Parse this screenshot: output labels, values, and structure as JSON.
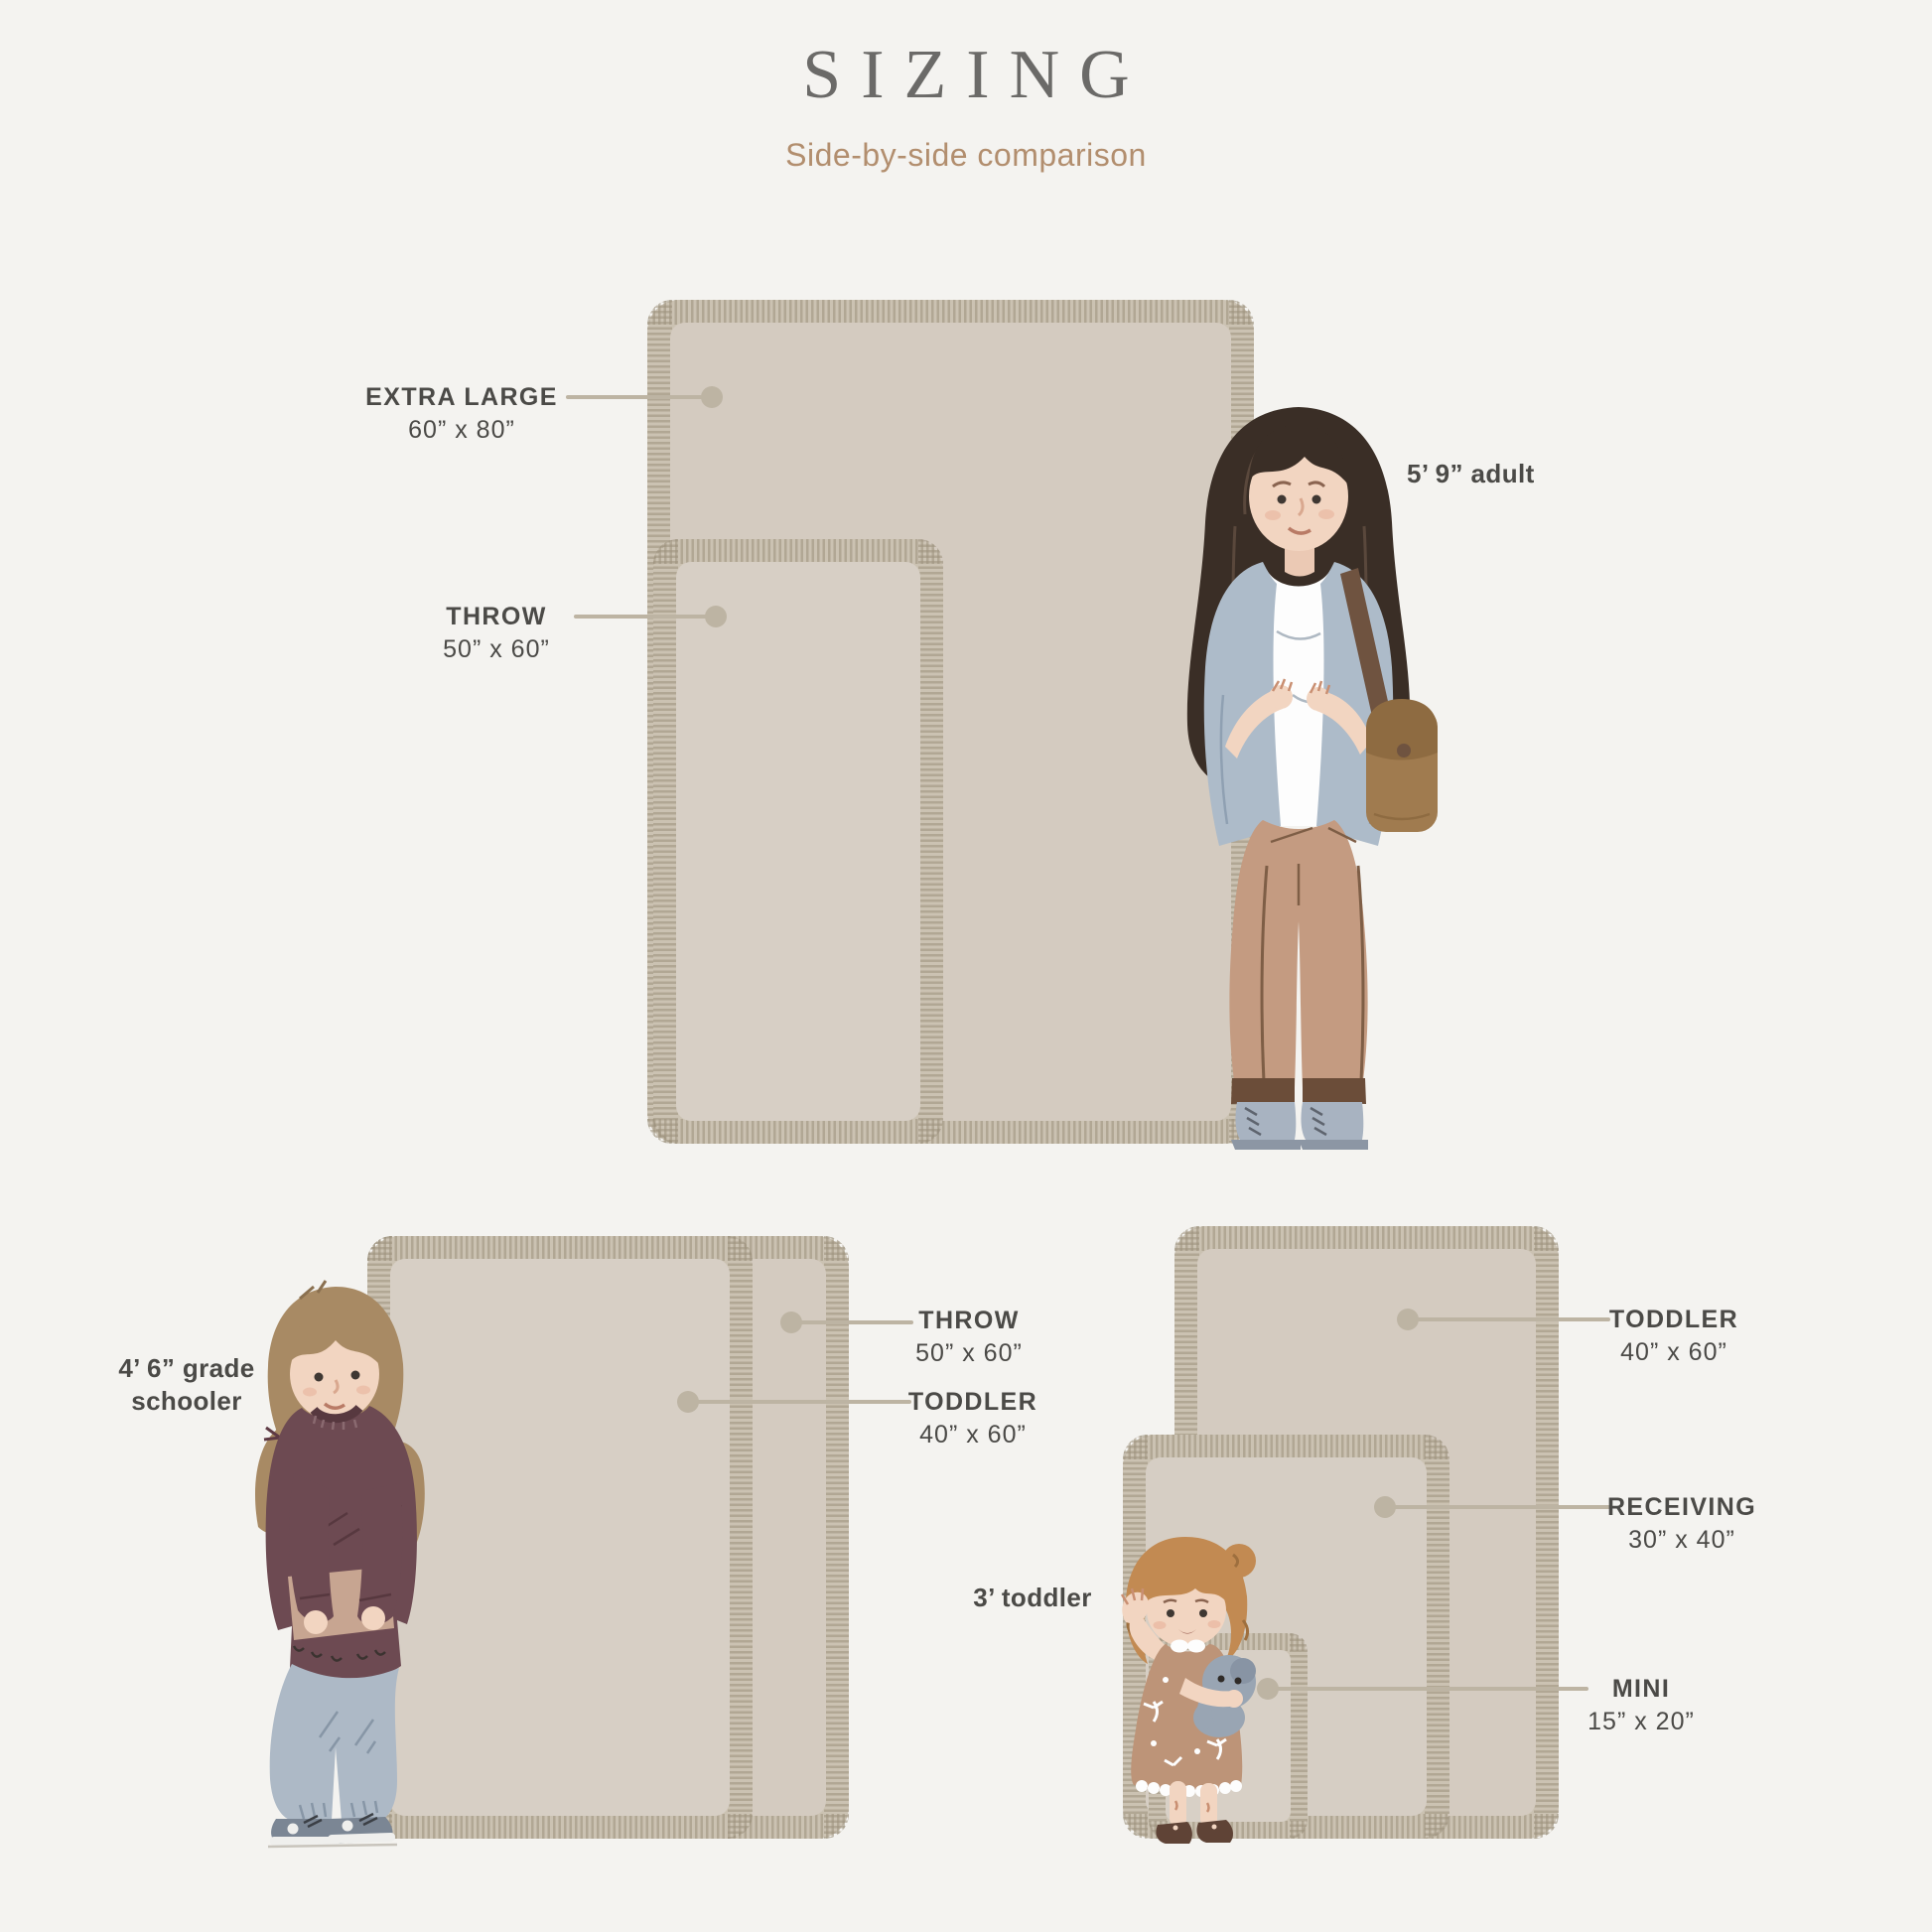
{
  "header": {
    "title": "SIZING",
    "subtitle": "Side-by-side comparison"
  },
  "figures": {
    "adult_label": "5’ 9” adult",
    "grade_schooler_label_line1": "4’ 6” grade",
    "grade_schooler_label_line2": "schooler",
    "toddler_label": "3’ toddler"
  },
  "callouts": {
    "extra_large": {
      "name": "EXTRA LARGE",
      "dims": "60” x 80”"
    },
    "throw_top": {
      "name": "THROW",
      "dims": "50” x 60”"
    },
    "throw_bottom_left": {
      "name": "THROW",
      "dims": "50” x 60”"
    },
    "toddler_bottom_left": {
      "name": "TODDLER",
      "dims": "40” x 60”"
    },
    "toddler_bottom_right": {
      "name": "TODDLER",
      "dims": "40” x 60”"
    },
    "receiving": {
      "name": "RECEIVING",
      "dims": "30” x 40”"
    },
    "mini": {
      "name": "MINI",
      "dims": "15” x 20”"
    }
  },
  "colors": {
    "background": "#F4F3F0",
    "blanket_fringe": "#CBC2B2",
    "blanket_fill": "#D5CCC1",
    "leader": "#BDB4A3",
    "label_text": "#4B4A47",
    "title": "#6B6A68",
    "subtitle": "#B28E6E"
  }
}
